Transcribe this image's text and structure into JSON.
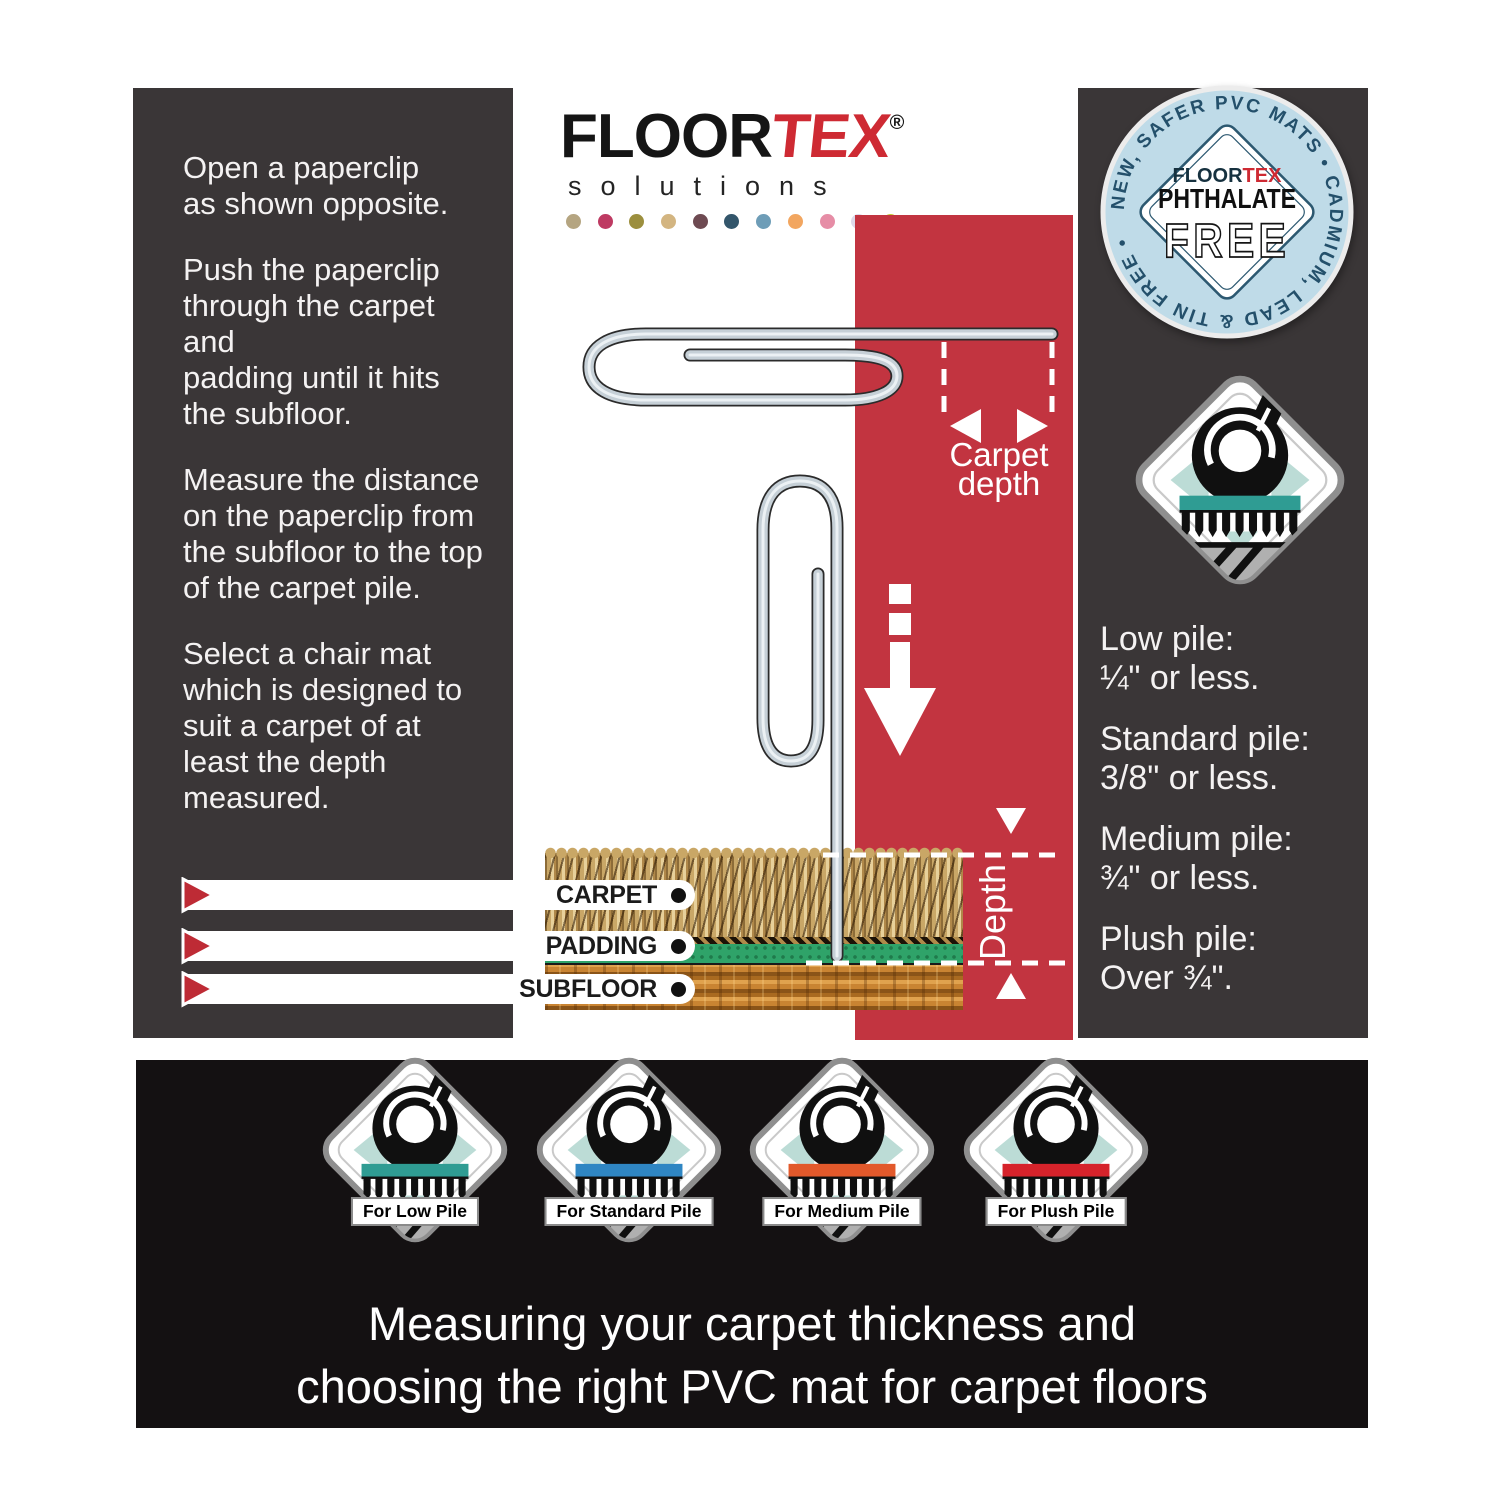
{
  "brand": {
    "black": "FLOOR",
    "red": "TEX",
    "reg": "®",
    "tagline": "solutions",
    "dots": [
      "#B5A581",
      "#BE3A62",
      "#9C8F3E",
      "#D3B581",
      "#6E4A52",
      "#33566B",
      "#6E9DB7",
      "#F2A660",
      "#E68DA6",
      "#DED9EA",
      "#C3CC2F"
    ]
  },
  "left_panel": {
    "paragraphs": [
      "Open a paperclip\nas shown opposite.",
      "Push the paperclip\nthrough the carpet and\npadding until it hits\nthe subfloor.",
      "Measure the distance\non the paperclip from\nthe subfloor to the top\nof the carpet pile.",
      "Select a chair mat\nwhich is designed to\nsuit a carpet of at\nleast the depth\nmeasured."
    ]
  },
  "measure": {
    "carpet_depth": "Carpet\ndepth",
    "depth": "Depth"
  },
  "layers": {
    "labels": [
      "CARPET",
      "PADDING",
      "SUBFLOOR"
    ]
  },
  "badge": {
    "ring": "NEW, SAFER PVC MATS • CADMIUM, LEAD & TIN FREE •",
    "brand_black": "FLOOR",
    "brand_red": "TEX",
    "line1": "PHTHALATE",
    "line2": "FREE"
  },
  "icon_top_right": {
    "color": "#2F9C93"
  },
  "pile_guide": {
    "items": [
      {
        "name": "Low pile:",
        "value": "¼\" or less."
      },
      {
        "name": "Standard pile:",
        "value": "3/8\" or less."
      },
      {
        "name": "Medium pile:",
        "value": "¾\" or less."
      },
      {
        "name": "Plush pile:",
        "value": "Over ¾\"."
      }
    ]
  },
  "mat_badges": {
    "items": [
      {
        "label": "For Low Pile",
        "color": "#2F9C93"
      },
      {
        "label": "For Standard Pile",
        "color": "#2F86C3"
      },
      {
        "label": "For Medium Pile",
        "color": "#E2592B"
      },
      {
        "label": "For Plush Pile",
        "color": "#D6232B"
      }
    ]
  },
  "footer": {
    "line1": "Measuring your carpet thickness and",
    "line2": "choosing the right PVC mat for carpet floors"
  },
  "colors": {
    "red_panel": "#C23440",
    "charcoal": "#3A3637",
    "footer_bg": "#141112",
    "accent_red": "#BE2B35",
    "badge_bg": "#BFDBE8",
    "mint": "#BCDCD6",
    "padding_green": "#2FA369"
  }
}
